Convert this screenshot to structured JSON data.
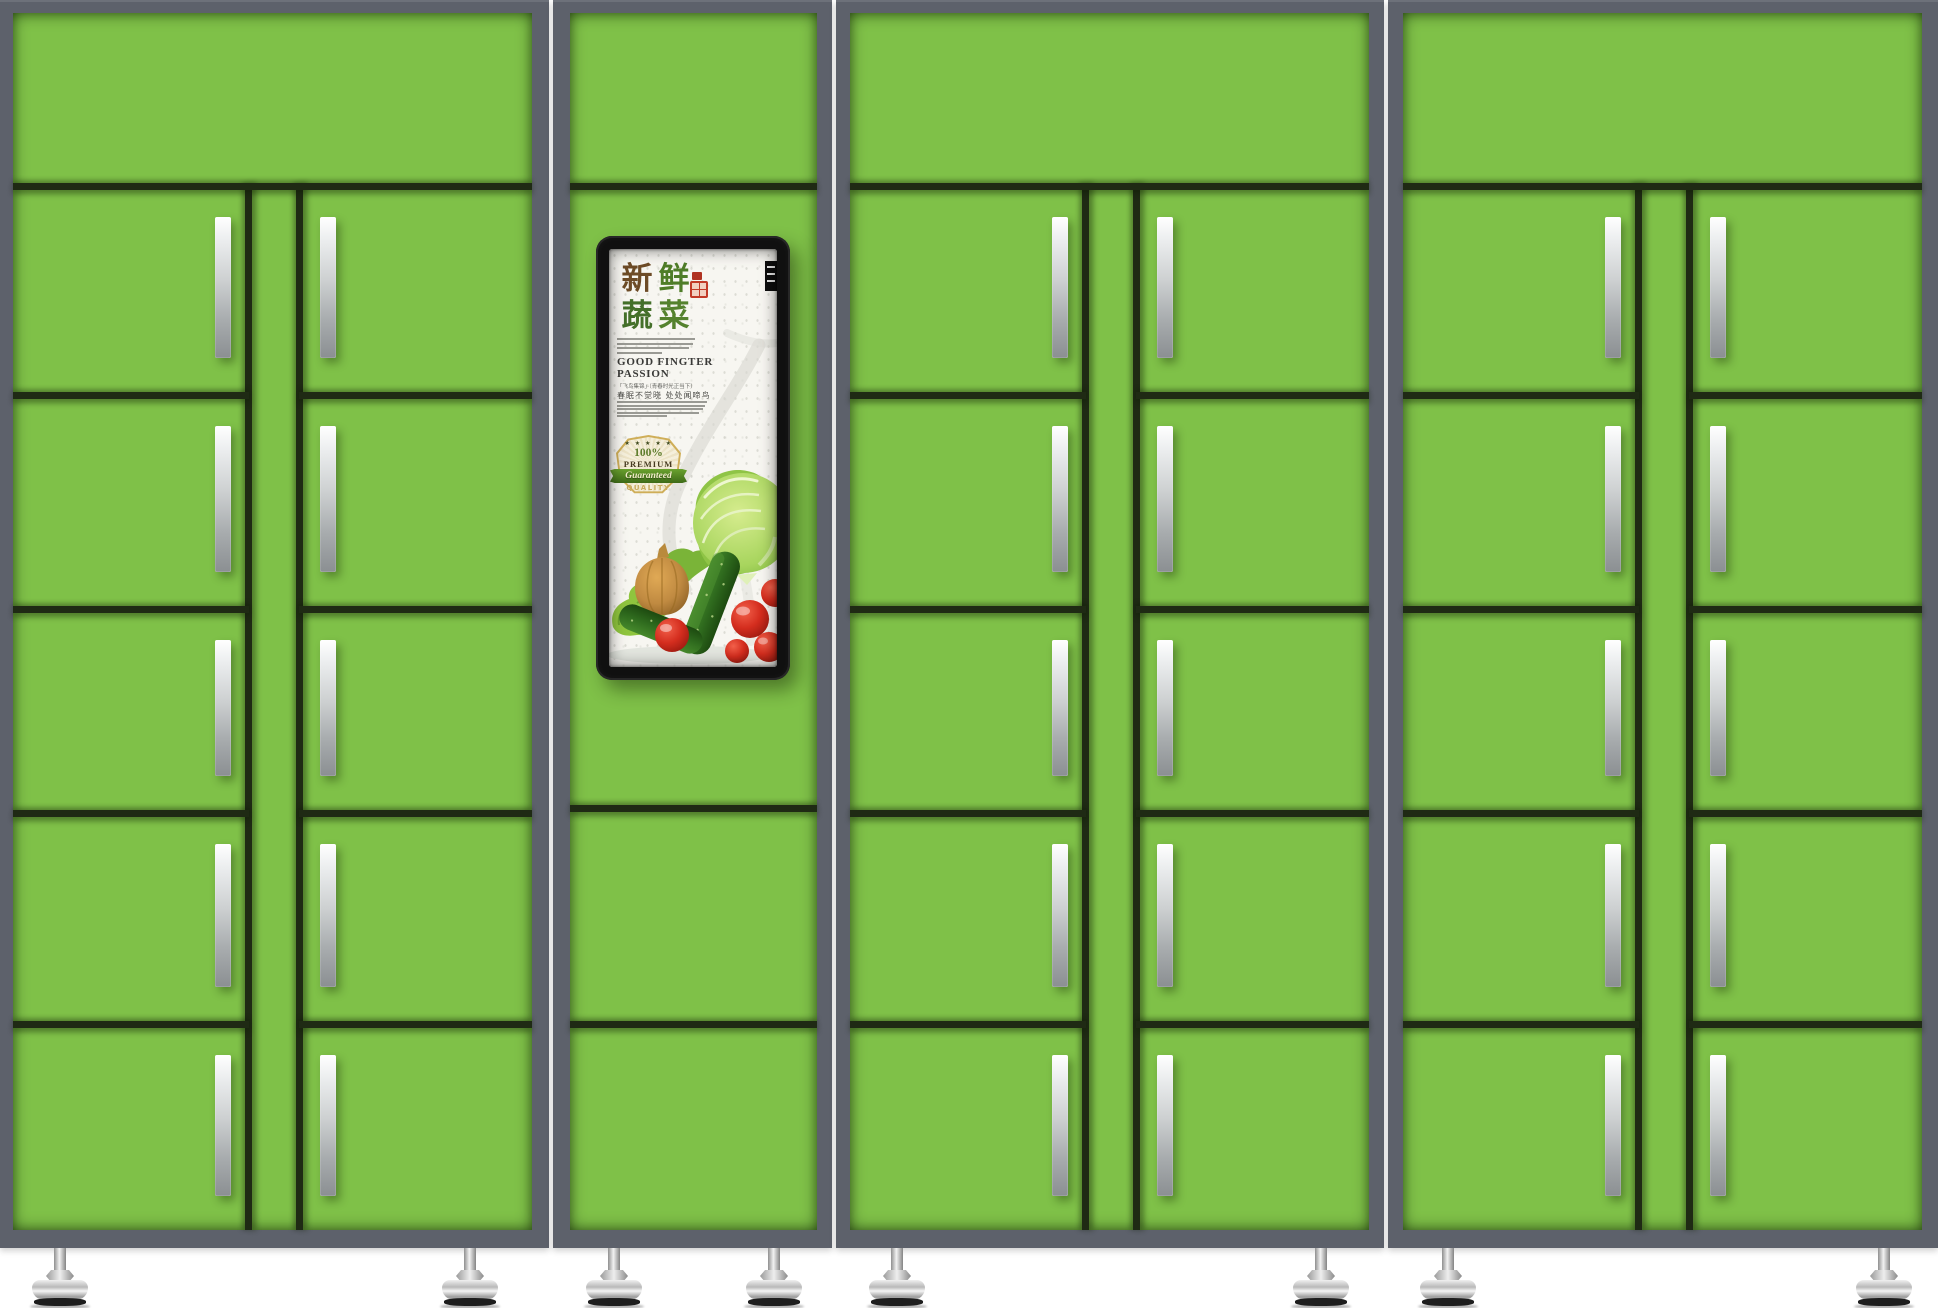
{
  "colors": {
    "door_green": "#7fc148",
    "frame_gray": "#5d616b",
    "divider_dark": "#1f2a14",
    "handle_silver": "#d9dbdd",
    "poster_bg": "#f7f6f1",
    "screen_black": "#101010",
    "seal_red": "#c23a28",
    "badge_cream": "#f5efdb",
    "ribbon_green": "#4c7d1f",
    "quality_gold": "#c8ab5e",
    "tomato_red": "#d42d1e",
    "cucumber_green": "#2f6b1e",
    "cabbage_green": "#9ed45c",
    "onion_brown": "#c08a41",
    "lettuce_green": "#8fc53e"
  },
  "cabinets": [
    {
      "id": "cabinet-1",
      "x": 0,
      "width": 549,
      "green_left": 13,
      "green_right": 17,
      "style": "double-door",
      "rows": [
        183,
        392,
        606,
        810,
        1021,
        1230
      ]
    },
    {
      "id": "cabinet-2",
      "x": 553,
      "width": 279,
      "green_left": 17,
      "green_right": 15,
      "style": "screen",
      "rows": [
        183,
        805,
        1021,
        1230
      ]
    },
    {
      "id": "cabinet-3",
      "x": 836,
      "width": 548,
      "green_left": 14,
      "green_right": 15,
      "style": "double-door",
      "rows": [
        183,
        392,
        606,
        810,
        1021,
        1230
      ]
    },
    {
      "id": "cabinet-4",
      "x": 1388,
      "width": 550,
      "green_left": 15,
      "green_right": 16,
      "style": "double-door",
      "rows": [
        183,
        392,
        606,
        810,
        1021,
        1230
      ]
    }
  ],
  "locker_geometry": {
    "divider_x1": 232,
    "divider_x2": 283,
    "handle_left_x": 202,
    "handle_right_x": 307,
    "handle_top_inset": 34,
    "handle_bottom_inset": 34
  },
  "feet_x": [
    60,
    470,
    614,
    774,
    897,
    1321,
    1448,
    1884
  ],
  "poster": {
    "title_chars": [
      "新",
      "鲜",
      "蔬",
      "菜"
    ],
    "heading_line1": "GOOD FINGTER",
    "heading_line2": "PASSION",
    "subtitle_cn": "「飞鸟集锦」·〔青春时光正当下〕",
    "poem_cn": "春眠不觉晓 处处闻啼鸟",
    "badge": {
      "stars": "★ ★ ★ ★ ★",
      "percent": "100%",
      "premium": "PREMIUM",
      "ribbon": "Guaranteed",
      "quality": "QUALITY"
    }
  }
}
